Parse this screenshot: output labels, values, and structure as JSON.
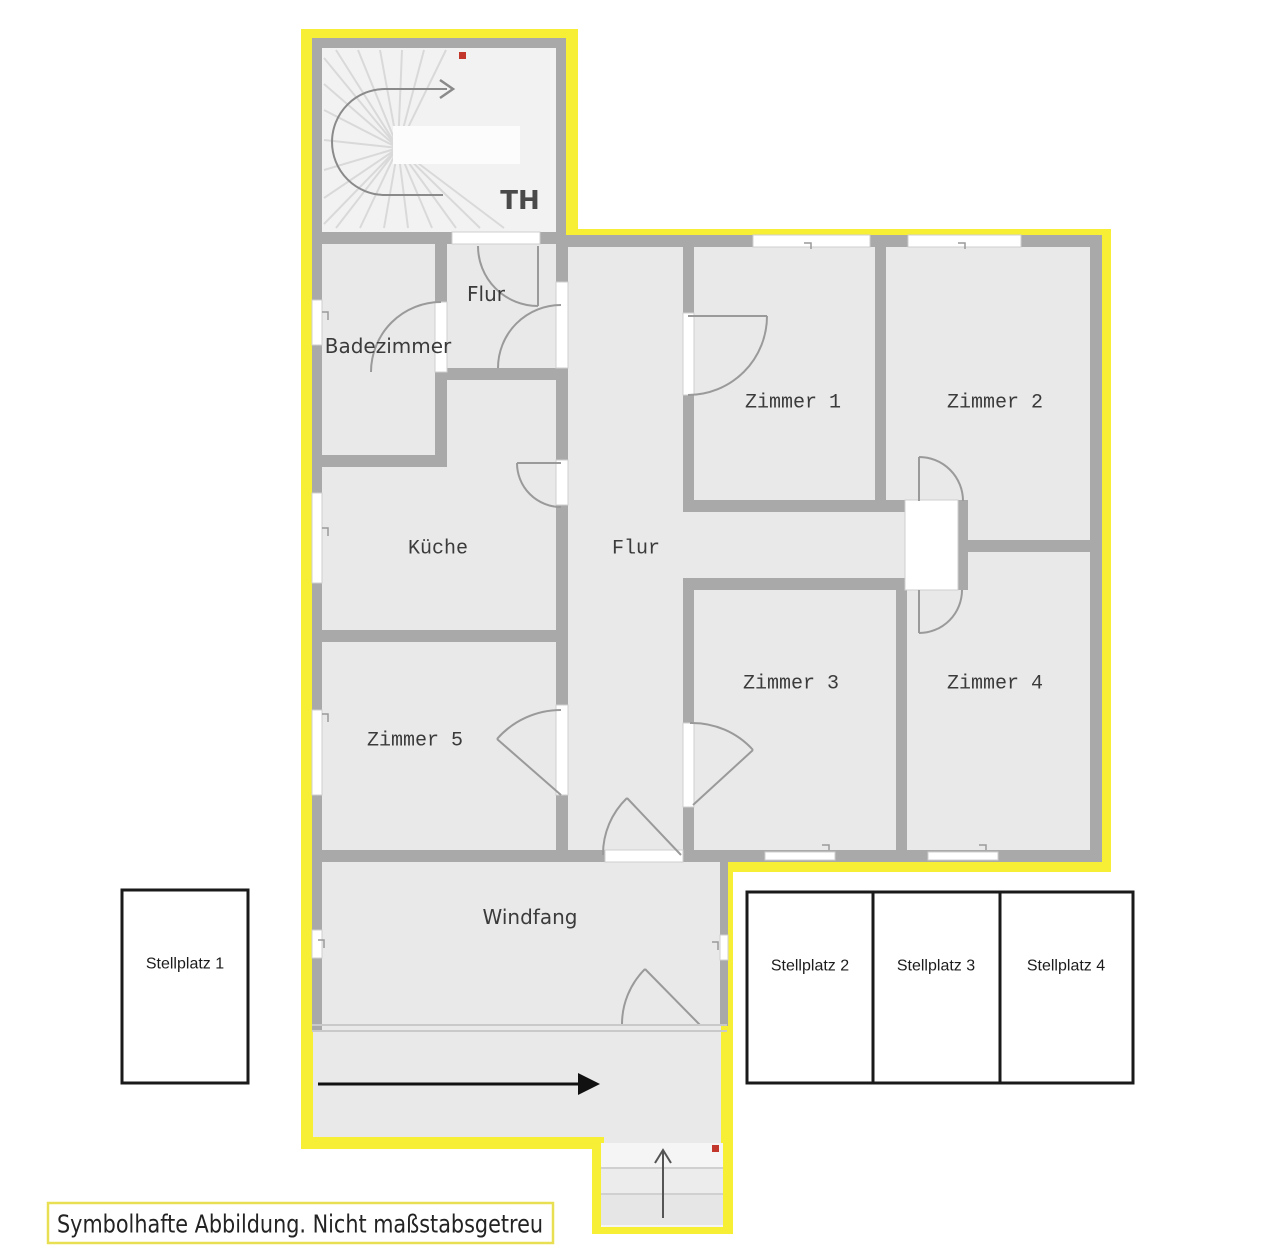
{
  "colors": {
    "boundary_yellow": "#f7ef35",
    "wall_gray": "#a9a9a9",
    "room_fill": "#e9e9e9",
    "stair_fill": "#f2f2f2",
    "door_arc": "#9a9a9a",
    "accent_red": "#c2362b",
    "parking_border": "#1a1a1a",
    "caption_border": "#e9df52"
  },
  "plan": {
    "stairwell_label": "TH",
    "rooms": {
      "flur_top": "Flur",
      "badezimmer": "Badezimmer",
      "kueche": "Küche",
      "flur": "Flur",
      "zimmer1": "Zimmer 1",
      "zimmer2": "Zimmer 2",
      "zimmer3": "Zimmer 3",
      "zimmer4": "Zimmer 4",
      "zimmer5": "Zimmer 5",
      "windfang": "Windfang"
    },
    "parking": {
      "p1": "Stellplatz 1",
      "p2": "Stellplatz 2",
      "p3": "Stellplatz 3",
      "p4": "Stellplatz 4"
    },
    "caption": "Symbolhafte Abbildung. Nicht maßstabsgetreu"
  }
}
